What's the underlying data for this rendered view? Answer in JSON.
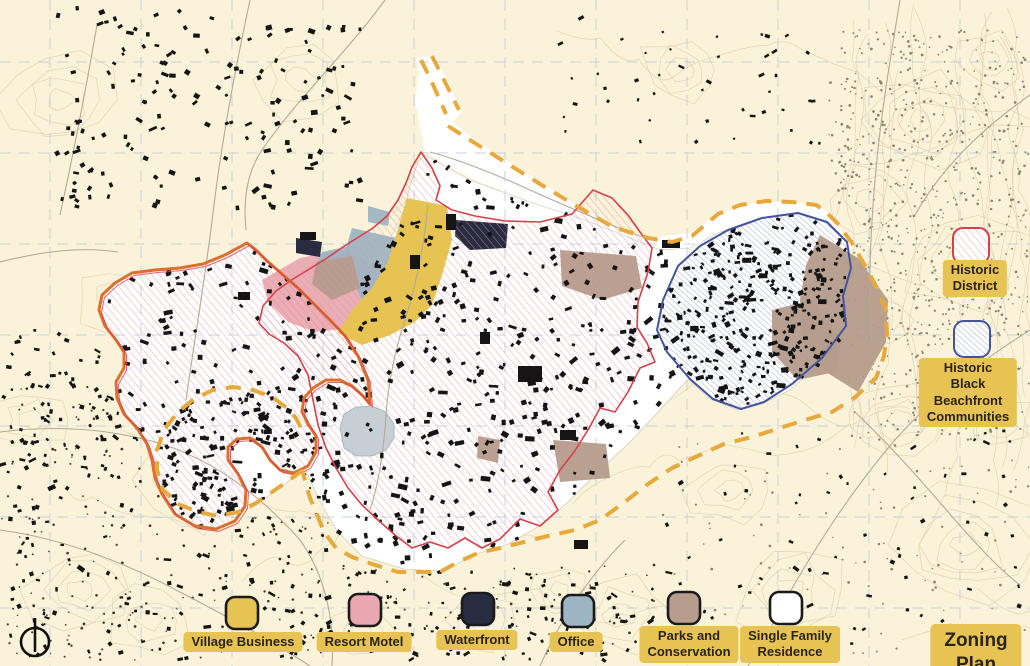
{
  "title": "Zoning Plan",
  "colors": {
    "map_bg": "#faf3da",
    "village_business": "#e7c353",
    "resort_motel": "#e9a7b1",
    "waterfront": "#272c41",
    "office": "#9db5c3",
    "parks": "#b59c8c",
    "single_family": "#ffffff",
    "historic_district": "#d6404a",
    "beachfront": "#44549c",
    "town_boundary": "#e8a93c",
    "badge": "#e7c353",
    "badge_text": "#2a2517"
  },
  "legend": {
    "zones": [
      {
        "label": "Village Business",
        "color": "#e7c353"
      },
      {
        "label": "Resort Motel",
        "color": "#e9a7b1"
      },
      {
        "label": "Waterfront",
        "color": "#272c41"
      },
      {
        "label": "Office",
        "color": "#9db5c3"
      },
      {
        "label": "Parks and\nConservation",
        "color": "#b59c8c"
      },
      {
        "label": "Single Family\nResidence",
        "color": "#ffffff"
      }
    ],
    "overlays": [
      {
        "label": "Historic\nDistrict",
        "stroke": "#d6404a"
      },
      {
        "label": "Historic Black\nBeachfront\nCommunities",
        "stroke": "#44549c"
      }
    ]
  }
}
